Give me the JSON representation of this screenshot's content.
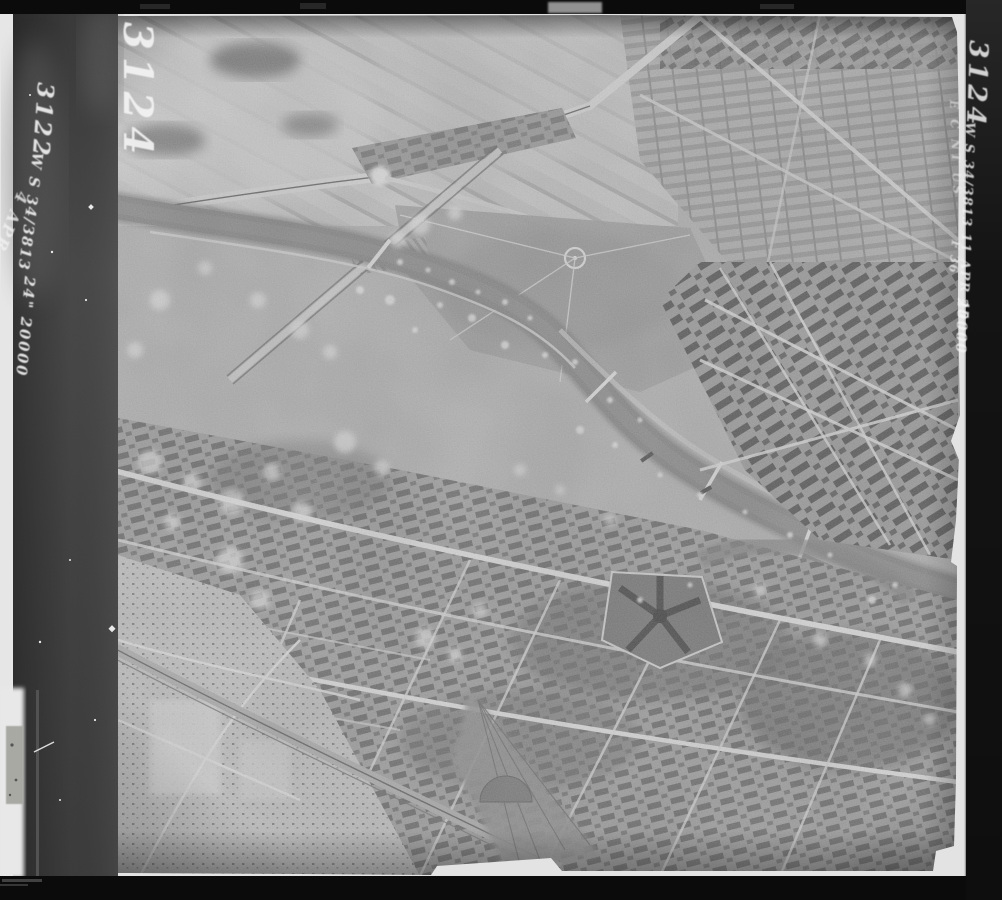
{
  "film_margin_left": {
    "outer_frame_number": "3122",
    "outer_sortie_line": "W S 34/3813",
    "outer_date_scribble": "4 APR 45",
    "outer_focal_scale": "24\" 20000",
    "inner_frame_number": "3124"
  },
  "photo_margin_right": {
    "frame_number": "3124",
    "sortie_line": "W S 34/3813 11 APR 45",
    "focal": "F 36",
    "scale": "20000",
    "stamp_fragment": "E C NT US"
  },
  "palette": {
    "frame_black": "#0b0b0b",
    "film_strip_gray": "#474747",
    "film_edge_white": "#e4e4e4",
    "photo_base_gray": "#b9b9b9",
    "river_gray": "#8d8d8d",
    "annotation_white": "#f2f2f2"
  }
}
